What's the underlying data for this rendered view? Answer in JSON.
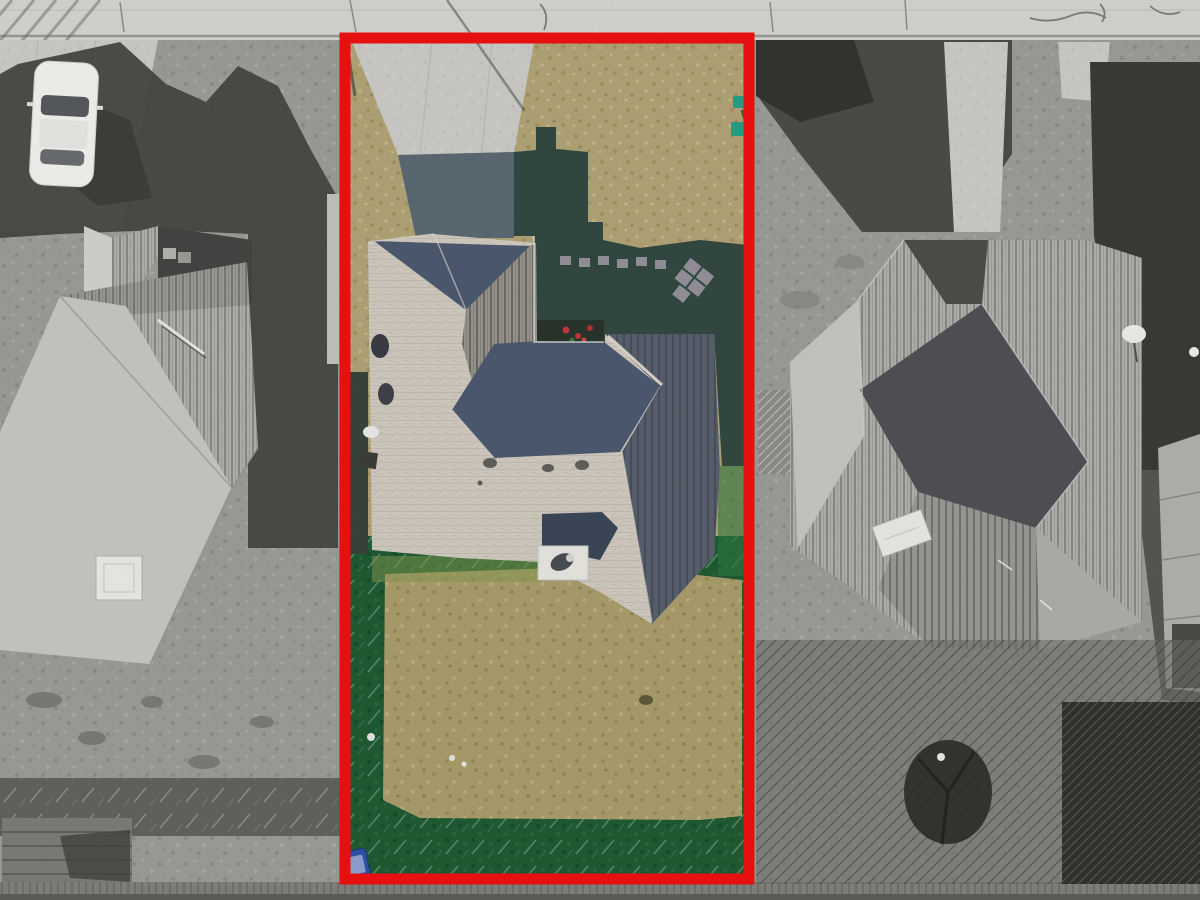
{
  "scene": {
    "kind": "aerial-drone-photograph",
    "style": "subject lot rendered in full color while neighboring properties are desaturated to grayscale",
    "highlight": "thick red rectangular property-boundary outline around the center lot"
  },
  "boundary": {
    "shape": "rectangle",
    "stroke_color": "#ef1111",
    "stroke_width_px": 11,
    "x": 345,
    "y": 38,
    "width": 404,
    "height": 841
  },
  "subject_property": {
    "features": [
      "concrete driveway at top-left of lot",
      "dormant tan front lawn with dark house shadow cast toward street",
      "hip-roof house with light beige shingles and dark slate shadowed slopes",
      "gray ribbed roof band on front-left wing",
      "stepping-stone path and angled paver cluster in shaded side yard",
      "courtyard flower bed with red blooms",
      "rooftop satellite dishes and equipment on left roof edge",
      "back patio with small dark hip roof, white equipment pad and round vent",
      "backyard of dormant tan grass surrounded by dark green watered border",
      "blue trash bin in bottom-left corner of backyard",
      "teal utility markers near top-right boundary"
    ]
  },
  "left_neighbor": {
    "features": [
      "white sedan parked on concrete driveway",
      "jagged house shadow across driveway",
      "large gray hip roof with ribbed upper face and bright lower face",
      "front gable wing",
      "white chimney",
      "pole lying on roof slope",
      "gray backyard with wooden deck at bottom-left"
    ]
  },
  "right_neighbor": {
    "features": [
      "dark tree shadows across front yard and right edge",
      "concrete front walkway",
      "gray hip roof with ribbed faces and dark shadowed slopes",
      "tilted white chimney",
      "white satellite dish",
      "dark tree in backyard",
      "partial roof of next house at far right"
    ]
  },
  "top_edge": "concrete sidewalk and street curb with expansion joints and cracks",
  "bottom_edge": "rear alley and fence line in shadow",
  "palette": {
    "boundary_red": "#ef1111",
    "sidewalk": "#d7d6d2",
    "concrete": "#cdccc8",
    "concrete_shadow": "#5c6a74",
    "lawn_tan": "#b2a577",
    "lawn_tan_back": "#ab9e6c",
    "lawn_green": "#1f5c34",
    "lawn_shadow": "#2d4540",
    "mulch": "#39443c",
    "roof_light": "#d3ccc2",
    "roof_dark": "#4d5a70",
    "roof_ribbed": "#9a9790",
    "roof_right_wing": "#59616e",
    "porch_roof": "#3c4858",
    "pad_white": "#e9e8e3",
    "gray_lawn": "#9d9d99",
    "gray_roof_light": "#c9c8c4",
    "gray_roof_ribbed": "#b3b2af",
    "gray_dark": "#4c4c48",
    "tree_dark": "#2f2f2b",
    "shadow_gray": "#474743",
    "car_white": "#f3f3f0",
    "bin_blue": "#2e51aa",
    "stone_paver": "#a09aa6",
    "flower_red": "#c13a3a",
    "utility_teal": "#2aa089",
    "alley": "#83827e"
  }
}
